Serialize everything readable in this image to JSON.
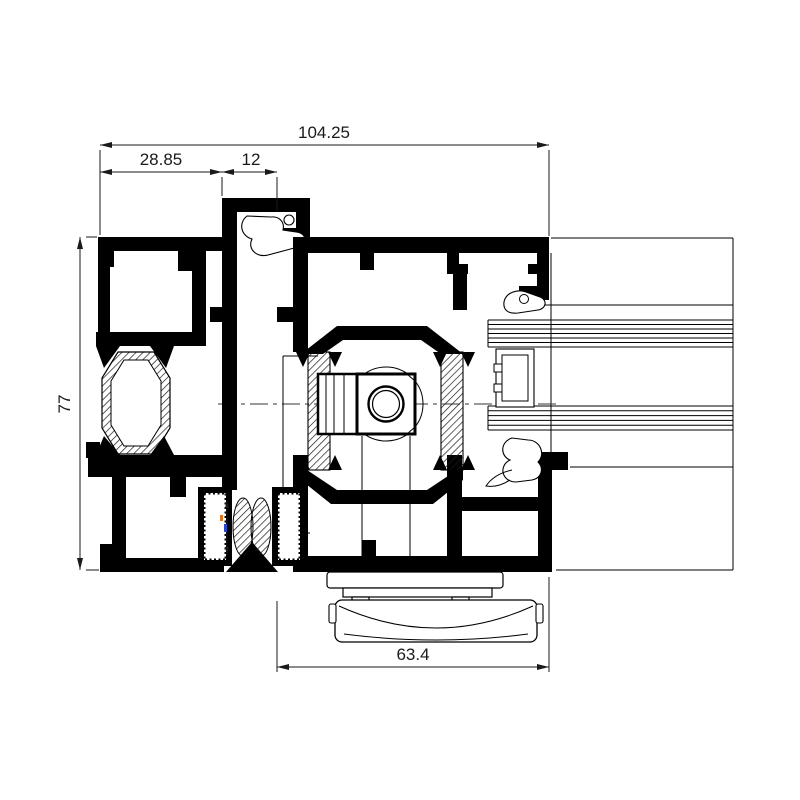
{
  "drawing": {
    "kind": "aluminium-profile-cross-section",
    "background": "#ffffff",
    "line_color": "#000000",
    "dimension_text_color": "#1a1a1a"
  },
  "dimensions": {
    "overall_width": "104.25",
    "frame_left_section": "28.85",
    "overlap": "12",
    "overall_height": "77",
    "sash_width": "63.4"
  }
}
